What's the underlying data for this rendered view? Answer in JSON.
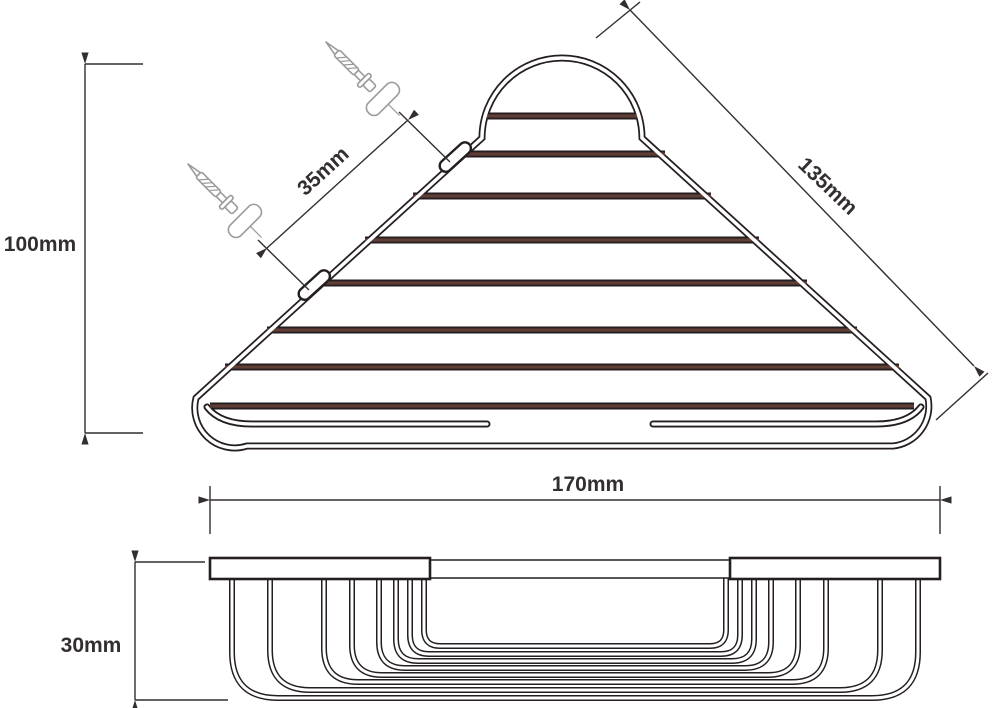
{
  "drawing": {
    "subject": "corner-basket-technical-drawing",
    "views": [
      {
        "id": "top",
        "name": "top-view"
      },
      {
        "id": "front",
        "name": "front-side-view"
      }
    ],
    "counts": {
      "wires_top_view": 8,
      "wires_side_view": 8,
      "mounting_tabs": 2,
      "screws": 2,
      "wall_plugs": 2
    }
  },
  "dimensions": {
    "height": {
      "label": "100mm"
    },
    "mount_spacing": {
      "label": "35mm"
    },
    "edge": {
      "label": "135mm"
    },
    "width": {
      "label": "170mm"
    },
    "depth": {
      "label": "30mm"
    }
  },
  "colors": {
    "ink": "#241e20",
    "wire_fill": "#5f3e36",
    "dimension": "#332e30",
    "screw": "#9b9b9b",
    "background": "#ffffff"
  }
}
